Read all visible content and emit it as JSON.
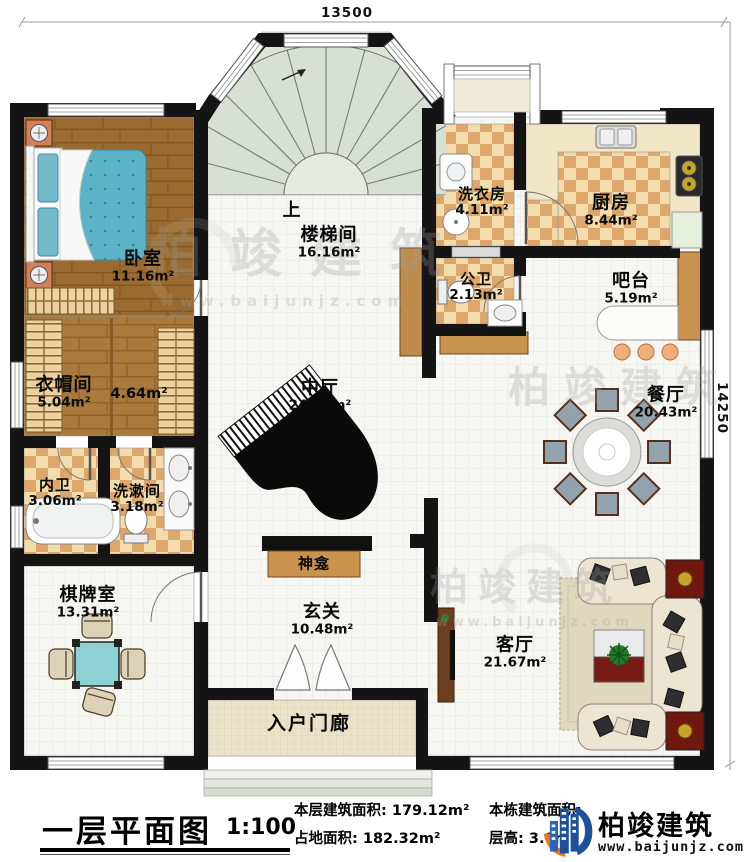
{
  "dimensions": {
    "top": "13500",
    "right": "14250"
  },
  "stair_up_label": "上",
  "rooms": {
    "bedroom": {
      "name": "卧室",
      "area": "11.16m²"
    },
    "cloakroom": {
      "name": "衣帽间",
      "area": "5.04m²"
    },
    "cloak_corridor": {
      "area": "4.64m²"
    },
    "master_bath": {
      "name": "内卫",
      "area": "3.06m²"
    },
    "washroom": {
      "name": "洗漱间",
      "area": "3.18m²"
    },
    "game_room": {
      "name": "棋牌室",
      "area": "13.31m²"
    },
    "stair_hall": {
      "name": "楼梯间",
      "area": "16.16m²"
    },
    "central_hall": {
      "name": "中厅",
      "area": "24.07m²"
    },
    "shrine": {
      "name": "神龛"
    },
    "foyer": {
      "name": "玄关",
      "area": "10.48m²"
    },
    "porch": {
      "name": "入户门廊"
    },
    "laundry": {
      "name": "洗衣房",
      "area": "4.11m²"
    },
    "public_bath": {
      "name": "公卫",
      "area": "2.13m²"
    },
    "kitchen": {
      "name": "厨房",
      "area": "8.44m²"
    },
    "bar": {
      "name": "吧台",
      "area": "5.19m²"
    },
    "dining": {
      "name": "餐厅",
      "area": "20.43m²"
    },
    "living": {
      "name": "客厅",
      "area": "21.67m²"
    }
  },
  "watermark": {
    "brand": "柏竣建筑",
    "website": "www.baijunjz.com"
  },
  "title_block": {
    "title": "一层平面图",
    "scale": "1:100",
    "floor_area_label": "本层建筑面积:",
    "floor_area_value": "179.12m²",
    "footprint_label": "占地面积:",
    "footprint_value": "182.32m²",
    "building_area_label": "本栋建筑面积:",
    "storey_height_label": "层高:",
    "storey_height_value": "3.0m",
    "brand": "柏竣建筑",
    "website": "www.baijunjz.com"
  },
  "colors": {
    "wall": "#141414",
    "checker_light": "#f2dcab",
    "checker_dark": "#dda76b",
    "wood": "#9a6b30",
    "stair": "#dde3d8",
    "accent_blue": "#1e4f9c",
    "accent_orange": "#f07818"
  }
}
